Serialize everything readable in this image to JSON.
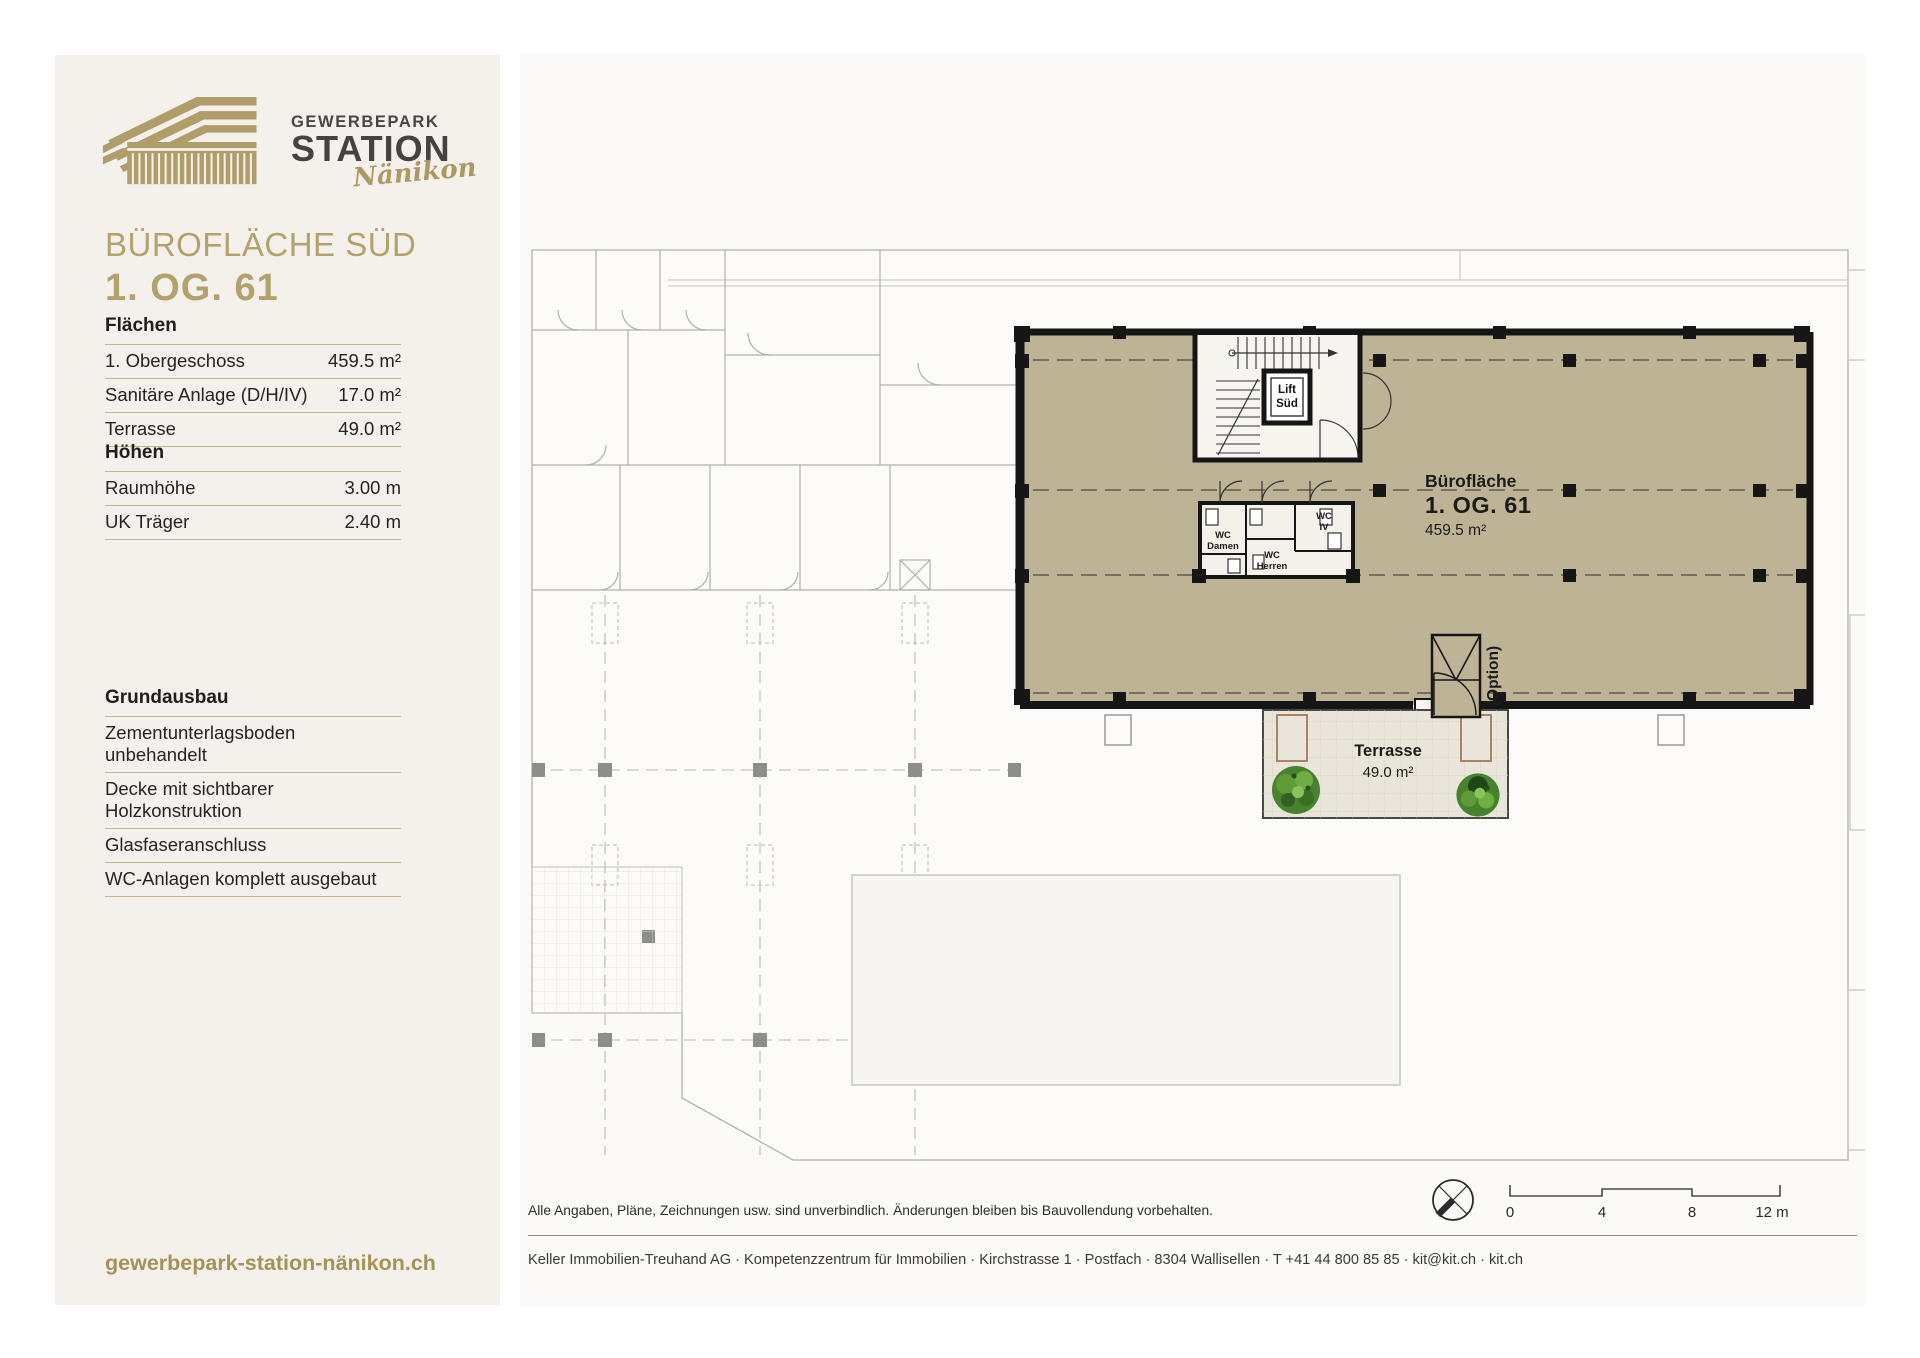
{
  "brand": {
    "name_line1": "GEWERBEPARK",
    "name_line2": "STATION",
    "name_line3": "Nänikon",
    "website": "gewerbepark-station-nänikon.ch",
    "gold": "#b2a06b",
    "dark": "#474140"
  },
  "header": {
    "title": "BÜROFLÄCHE SÜD",
    "subtitle": "1. OG. 61"
  },
  "sections": {
    "flaechen": {
      "heading": "Flächen",
      "rows": [
        {
          "label": "1. Obergeschoss",
          "value": "459.5 m²"
        },
        {
          "label": "Sanitäre Anlage (D/H/IV)",
          "value": "17.0 m²"
        },
        {
          "label": "Terrasse",
          "value": "49.0 m²"
        }
      ]
    },
    "hoehen": {
      "heading": "Höhen",
      "rows": [
        {
          "label": "Raumhöhe",
          "value": "3.00 m"
        },
        {
          "label": "UK Träger",
          "value": "2.40 m"
        }
      ]
    },
    "grundausbau": {
      "heading": "Grundausbau",
      "items": [
        "Zementunterlagsboden unbehandelt",
        "Decke mit sichtbarer Holzkonstruktion",
        "Glasfaseranschluss",
        "WC-Anlagen komplett ausgebaut"
      ]
    }
  },
  "plan": {
    "highlight_color": "#bfb396",
    "area_label": {
      "line1": "Bürofläche",
      "line2": "1. OG. 61",
      "line3": "459.5 m²"
    },
    "terrace": {
      "line1": "Terrasse",
      "line2": "49.0 m²"
    },
    "lift": {
      "line1": "Lift",
      "line2": "Süd"
    },
    "wc_damen": {
      "line1": "WC",
      "line2": "Damen"
    },
    "wc_herren": {
      "line1": "WC",
      "line2": "Herren"
    },
    "wc_iv": {
      "line1": "WC",
      "line2": "IV"
    },
    "option_label": "(Option)"
  },
  "scalebar": {
    "t0": "0",
    "t4": "4",
    "t8": "8",
    "t12": "12 m"
  },
  "footer": {
    "disclaimer": "Alle Angaben, Pläne, Zeichnungen usw. sind unverbindlich. Änderungen bleiben bis Bauvollendung vorbehalten.",
    "contact": "Keller Immobilien-Treuhand AG · Kompetenzzentrum für Immobilien · Kirchstrasse 1 · Postfach · 8304 Wallisellen · T +41 44 800 85 85 · kit@kit.ch · kit.ch"
  }
}
